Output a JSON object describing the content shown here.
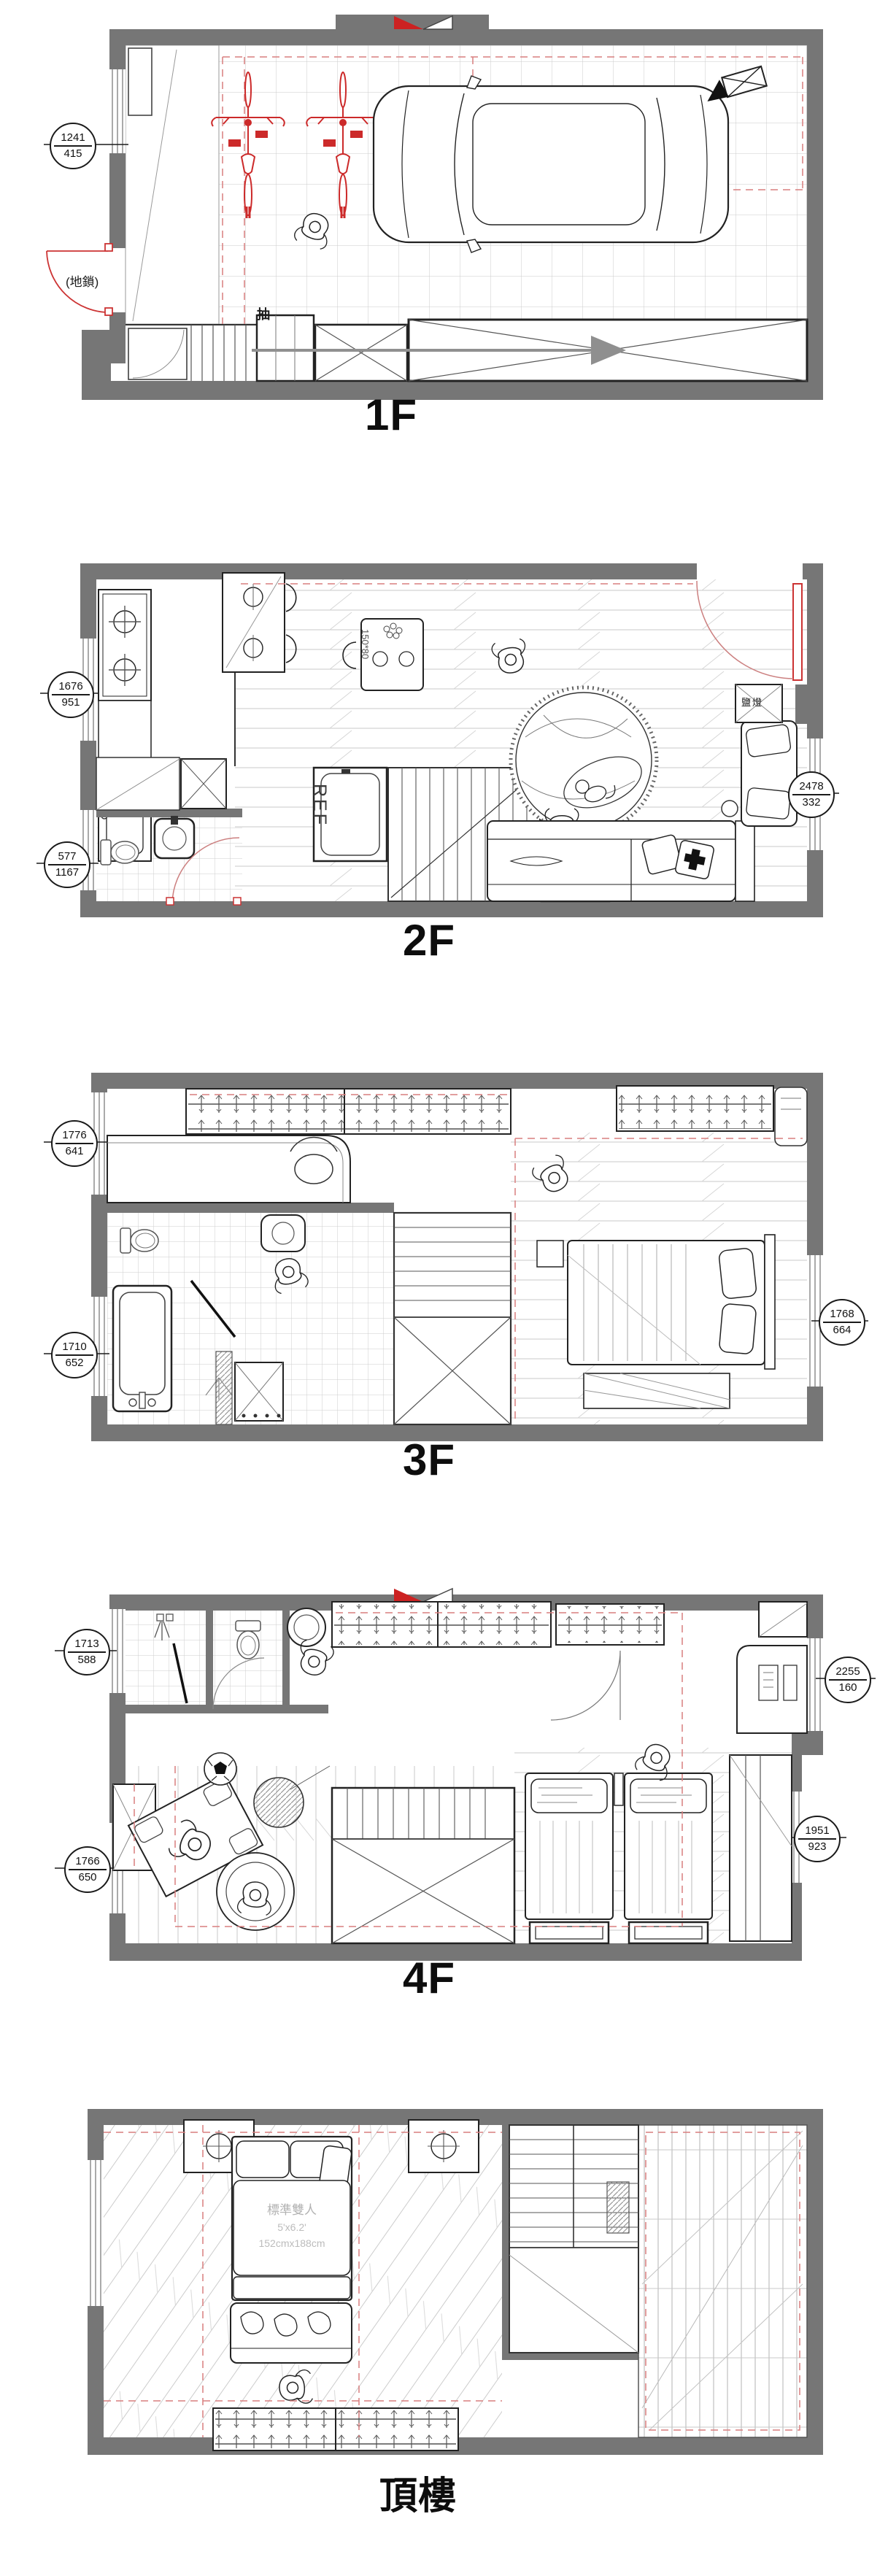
{
  "sheet": {
    "type": "multi-storey residential floor plans",
    "floors": [
      {
        "label": "1F"
      },
      {
        "label": "2F"
      },
      {
        "label": "3F"
      },
      {
        "label": "4F"
      },
      {
        "label": "頂樓"
      }
    ]
  },
  "annotations": {
    "ground_lock": "(地鎖)",
    "drawer": "抽",
    "salt_lamp": "鹽燈",
    "fridge": "REF",
    "table_size": "150*80",
    "bed_type": "標準雙人",
    "bed_size_ft": "5'x6.2'",
    "bed_size_cm": "152cmx188cm"
  },
  "dim_bubbles": [
    {
      "floor": "1F",
      "top": "1241",
      "bottom": "415"
    },
    {
      "floor": "2F",
      "top": "1676",
      "bottom": "951"
    },
    {
      "floor": "2F",
      "top": "577",
      "bottom": "1167"
    },
    {
      "floor": "2F",
      "top": "2478",
      "bottom": "332"
    },
    {
      "floor": "3F",
      "top": "1776",
      "bottom": "641"
    },
    {
      "floor": "3F",
      "top": "1710",
      "bottom": "652"
    },
    {
      "floor": "3F",
      "top": "1768",
      "bottom": "664"
    },
    {
      "floor": "4F",
      "top": "1713",
      "bottom": "588"
    },
    {
      "floor": "4F",
      "top": "1766",
      "bottom": "650"
    },
    {
      "floor": "4F",
      "top": "2255",
      "bottom": "160"
    },
    {
      "floor": "4F",
      "top": "1951",
      "bottom": "923"
    }
  ],
  "colors": {
    "wall": "#767676",
    "grid": "#c9c9c9",
    "red_accent": "#cc2a2a",
    "red_dash": "#d97f7f",
    "outline": "#222222"
  }
}
